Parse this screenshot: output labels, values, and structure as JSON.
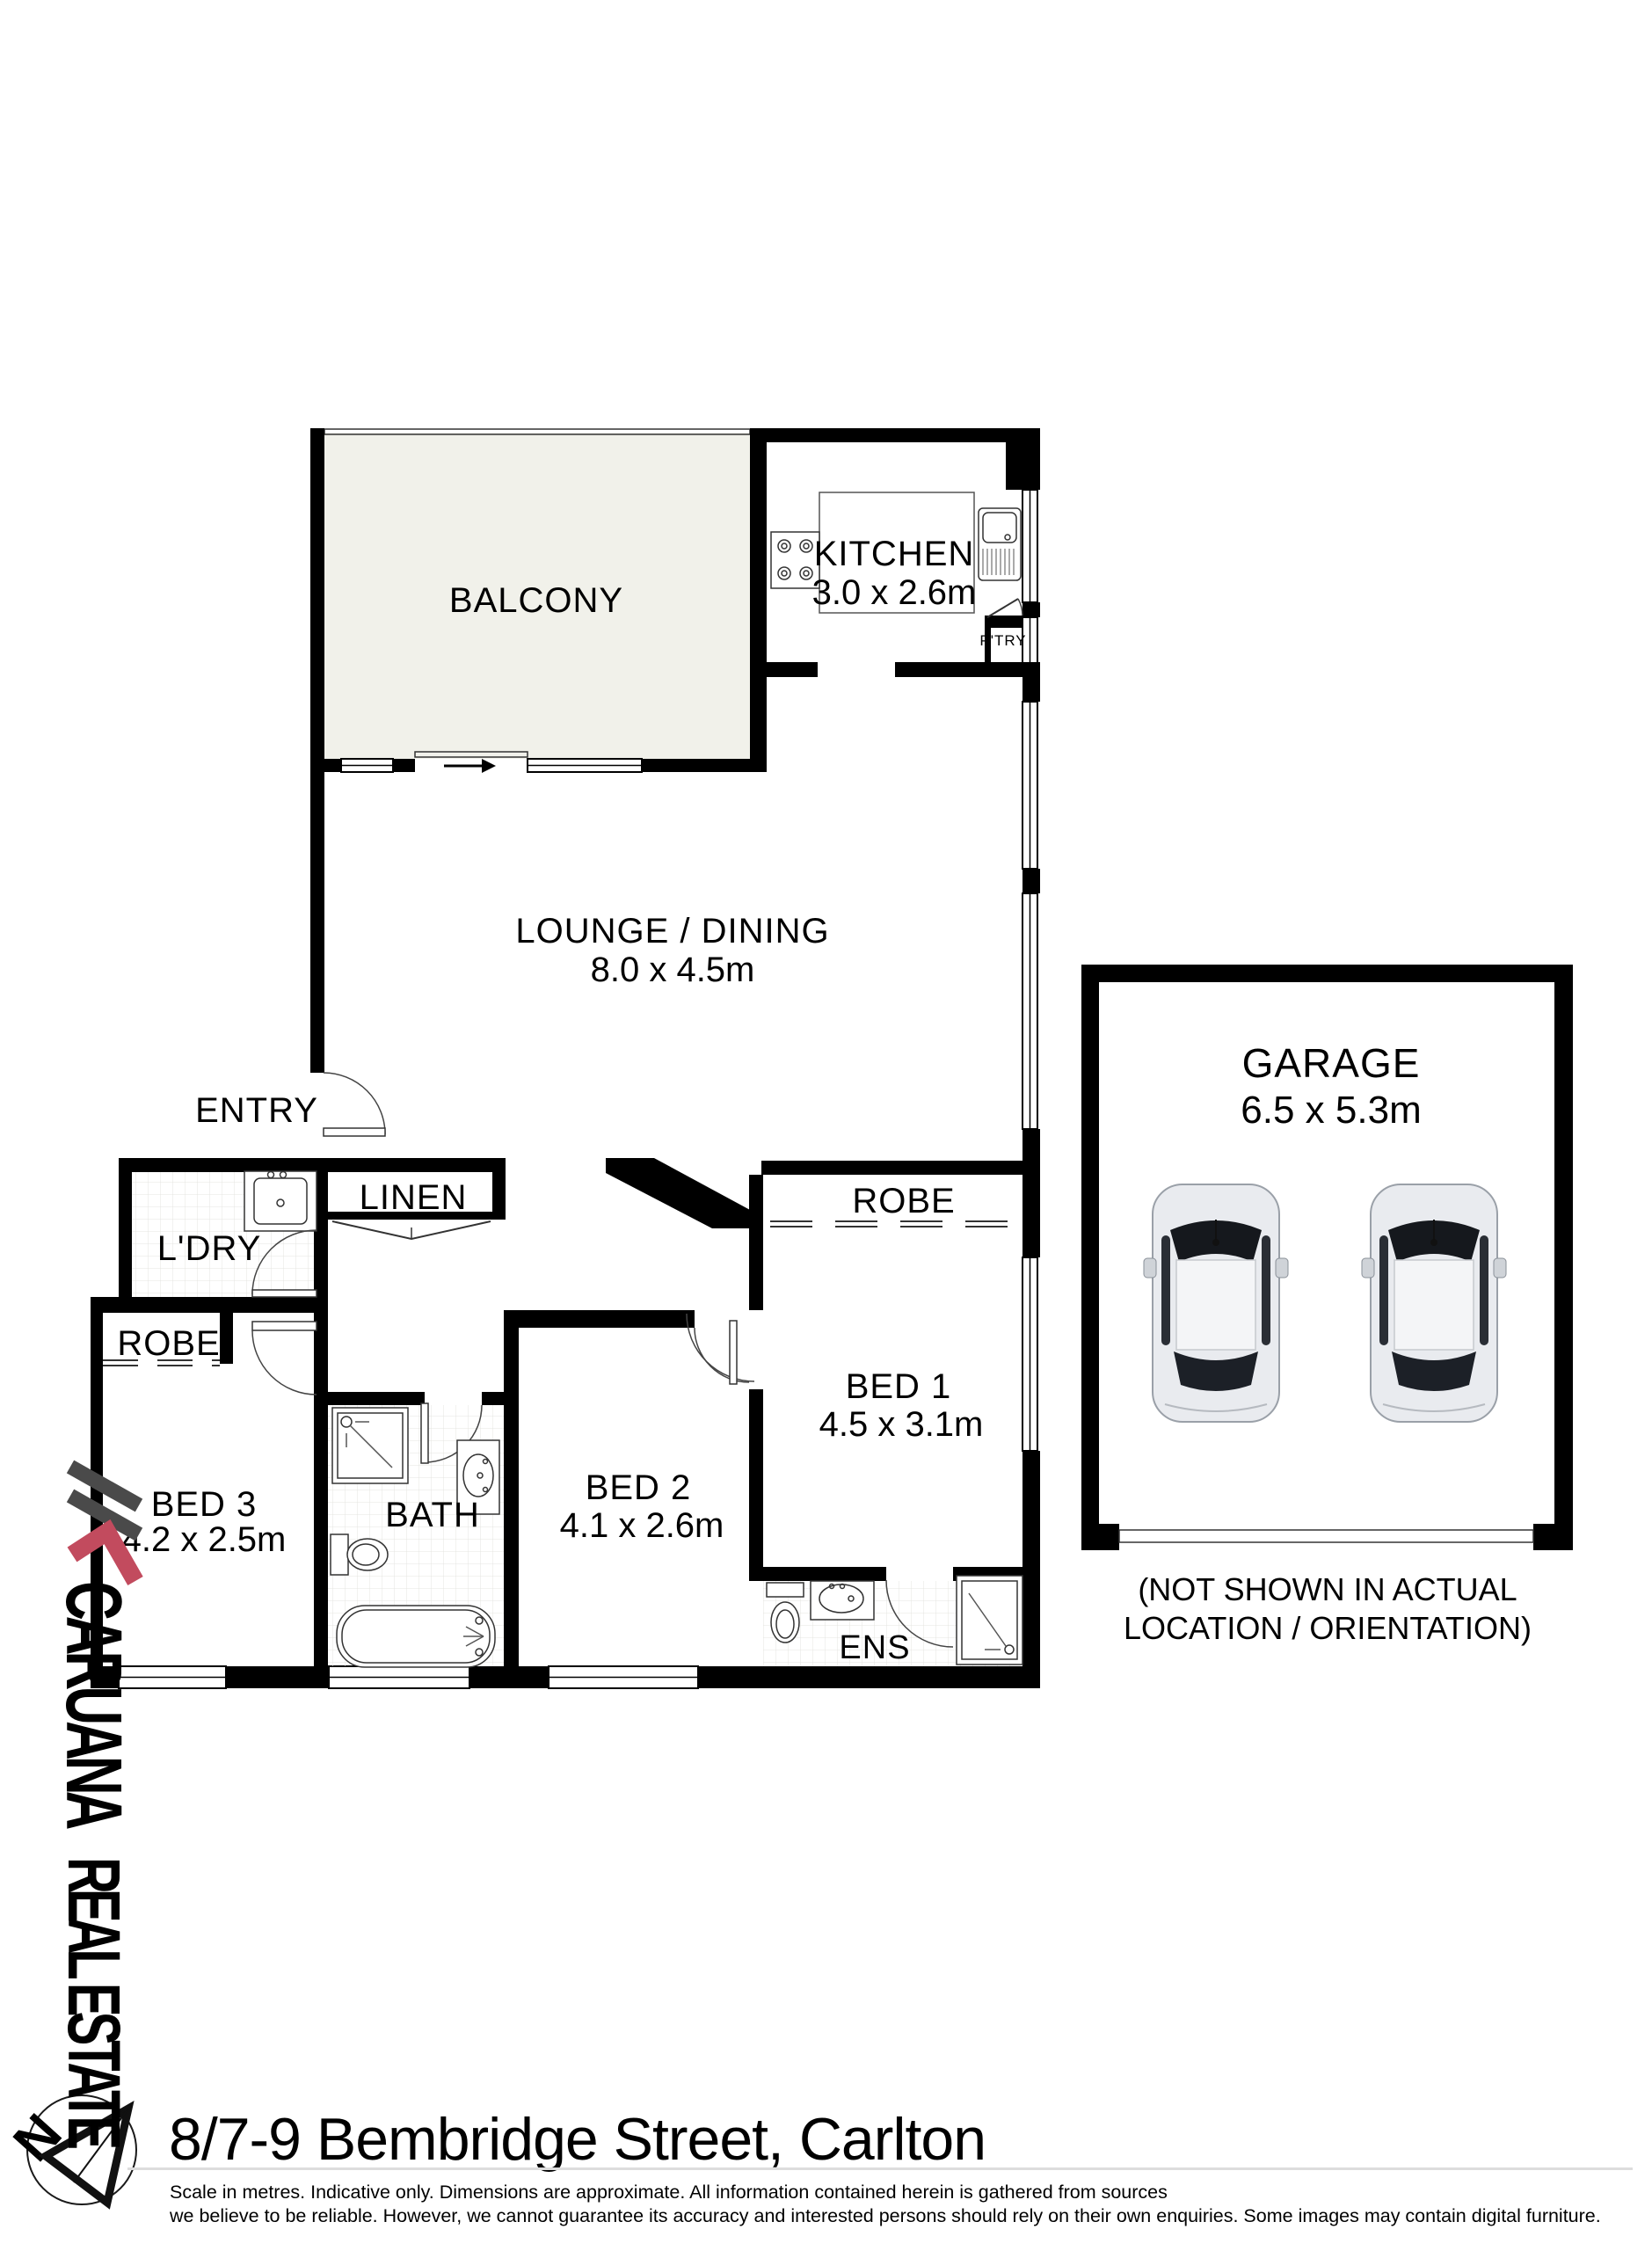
{
  "rooms": {
    "balcony": {
      "label": "BALCONY"
    },
    "kitchen": {
      "label": "KITCHEN",
      "dims": "3.0 x 2.6m"
    },
    "lounge": {
      "label": "LOUNGE / DINING",
      "dims": "8.0 x 4.5m"
    },
    "entry": {
      "label": "ENTRY"
    },
    "linen": {
      "label": "LINEN"
    },
    "laundry": {
      "label": "L'DRY"
    },
    "robe_hall": {
      "label": "ROBE"
    },
    "robe_bed1": {
      "label": "ROBE"
    },
    "bed1": {
      "label": "BED 1",
      "dims": "4.5 x 3.1m"
    },
    "bed2": {
      "label": "BED 2",
      "dims": "4.1 x 2.6m"
    },
    "bed3": {
      "label": "BED 3",
      "dims": "4.2 x 2.5m"
    },
    "bath": {
      "label": "BATH"
    },
    "ens": {
      "label": "ENS"
    },
    "pantry": {
      "label": "P'TRY"
    }
  },
  "garage": {
    "label": "GARAGE",
    "dims": "6.5 x 5.3m",
    "note_line1": "(NOT SHOWN IN ACTUAL",
    "note_line2": "LOCATION / ORIENTATION)"
  },
  "branding": {
    "brand_name": "CARUANA",
    "brand_suffix": "REAL ESTATE",
    "north_letter": "N",
    "brand_red": "#c24b5e",
    "brand_gray": "#4f4f4f"
  },
  "footer": {
    "address": "8/7-9 Bembridge Street, Carlton",
    "disclaimer_line1": "Scale in metres. Indicative only. Dimensions are approximate. All information contained herein is gathered from sources",
    "disclaimer_line2": "we believe to be reliable. However, we cannot guarantee its accuracy and interested persons should rely on their own enquiries. Some images may contain digital furniture."
  },
  "colors": {
    "wall": "#000000",
    "balcony_fill": "#f1f1ea",
    "tile_line": "#e4e4e0",
    "rule": "#dddddd"
  }
}
